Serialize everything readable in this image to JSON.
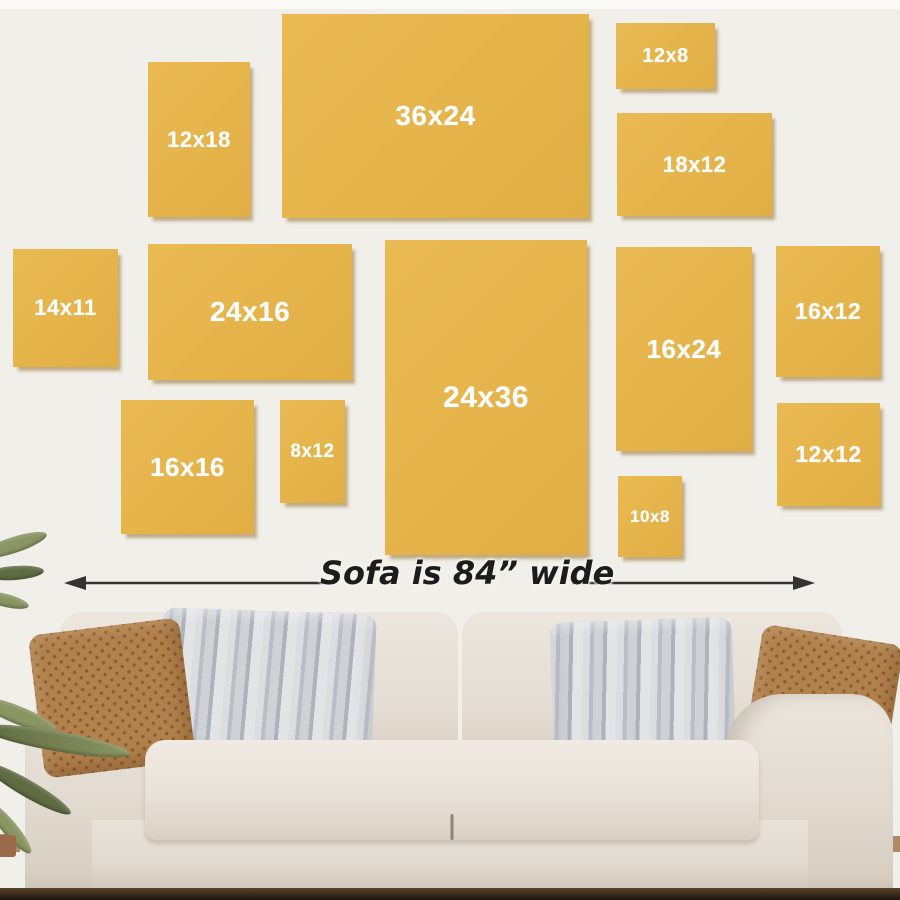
{
  "annotation": {
    "label": "Sofa is 84” wide"
  },
  "canvases": [
    {
      "label": "12x18",
      "x": 148,
      "y": 62,
      "w": 102,
      "h": 155,
      "fs": 22
    },
    {
      "label": "36x24",
      "x": 282,
      "y": 14,
      "w": 307,
      "h": 204,
      "fs": 28
    },
    {
      "label": "12x8",
      "x": 616,
      "y": 23,
      "w": 99,
      "h": 66,
      "fs": 20
    },
    {
      "label": "18x12",
      "x": 617,
      "y": 113,
      "w": 155,
      "h": 103,
      "fs": 22
    },
    {
      "label": "14x11",
      "x": 13,
      "y": 249,
      "w": 105,
      "h": 118,
      "fs": 22
    },
    {
      "label": "24x16",
      "x": 148,
      "y": 244,
      "w": 204,
      "h": 136,
      "fs": 28
    },
    {
      "label": "24x36",
      "x": 385,
      "y": 240,
      "w": 202,
      "h": 315,
      "fs": 30
    },
    {
      "label": "16x24",
      "x": 616,
      "y": 247,
      "w": 136,
      "h": 204,
      "fs": 26
    },
    {
      "label": "16x12",
      "x": 776,
      "y": 246,
      "w": 104,
      "h": 131,
      "fs": 23
    },
    {
      "label": "16x16",
      "x": 121,
      "y": 400,
      "w": 133,
      "h": 134,
      "fs": 26
    },
    {
      "label": "8x12",
      "x": 280,
      "y": 400,
      "w": 65,
      "h": 103,
      "fs": 19
    },
    {
      "label": "10x8",
      "x": 618,
      "y": 476,
      "w": 64,
      "h": 81,
      "fs": 17
    },
    {
      "label": "12x12",
      "x": 777,
      "y": 403,
      "w": 103,
      "h": 103,
      "fs": 23
    }
  ],
  "colors": {
    "wall": "#f1efe9",
    "top_strip": "#fbfaf7",
    "canvas_yellow": "#e9b546",
    "canvas_shadow": "rgba(141,106,36,0.5)",
    "label_text": "#ffffff",
    "arrow": "#333333",
    "annotation_text": "#1c1c1c",
    "pillow_brown": "#b2824d",
    "pillow_brown_dot": "#8a5c31",
    "pillow_gray": "#d6d7da",
    "pillow_gray_stripe": "#aeb2bc",
    "floor_dark": "#5a452e",
    "floor_wood": "#b08a67",
    "plant_green": "#8a9562",
    "plant_green_dark": "#5f6b42",
    "pot": "#9c6a4a"
  }
}
